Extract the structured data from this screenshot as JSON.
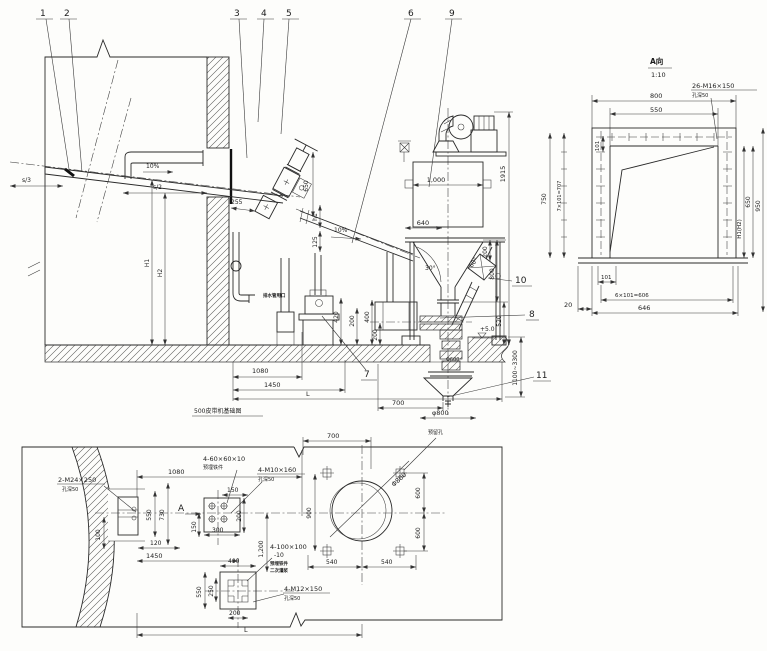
{
  "callouts": {
    "c1": "1",
    "c2": "2",
    "c3": "3",
    "c4": "4",
    "c5": "5",
    "c6": "6",
    "c7": "7",
    "c8": "8",
    "c9": "9",
    "c10": "10",
    "c11": "11"
  },
  "elev": {
    "s3": "s/3",
    "s2": "s/2",
    "slope_a": "10%",
    "slope_b": "10%",
    "d255": "255",
    "d650": "650",
    "h1": "h1",
    "d125": "125",
    "H1": "H1",
    "H2": "H2",
    "d1000": "1,000",
    "d640": "640",
    "d1915": "1915",
    "deg30": "30°",
    "deg60": "60°",
    "d200r": "200",
    "d800r": "800",
    "d520": "520",
    "level": "+5.0",
    "pit_depth": "1100~3300",
    "phi600": "Φ600",
    "d420": "420",
    "d200a": "200",
    "d400": "400",
    "d200b": "200",
    "d1080": "1080",
    "d1450": "1450",
    "L": "L",
    "d700": "700",
    "phi800": "φ800",
    "note500": "500皮带机基础图",
    "drain_note": "排水管甩口"
  },
  "detail": {
    "title": "A向",
    "scale": "1:10",
    "bolts": "26-M16×150",
    "bolts_note": "孔深50",
    "d800": "800",
    "d550": "550",
    "d101a": "101",
    "d7x101": "7×101=707",
    "d750": "750",
    "d650": "650",
    "d950": "950",
    "hh": "H1(H2)",
    "d101b": "101",
    "d6x101": "6×101=606",
    "d646": "646",
    "d20": "20"
  },
  "plan": {
    "m24": "2-M24×250",
    "m24_note": "孔深50",
    "p60": "4-60×60×10",
    "p60_note": "预埋铁件",
    "m10": "4-M10×160",
    "m10_note": "孔深50",
    "d150a": "150",
    "d200a": "200",
    "d300": "300",
    "d150b": "150",
    "d100": "100",
    "d550a": "550",
    "d730": "730",
    "d120": "120",
    "d1080": "1080",
    "A": "A",
    "d900": "900",
    "d700": "700",
    "phi800": "Φ800",
    "hole_note": "预留孔",
    "d600a": "600",
    "d600b": "600",
    "d540a": "540",
    "d540b": "540",
    "d1450": "1450",
    "d400": "400",
    "d550b": "550",
    "d250": "250",
    "d1200": "1,200",
    "d200b": "200",
    "p100": "4-100×100",
    "p100_t": "-10",
    "p100_n1": "预埋铁件",
    "p100_n2": "二次灌浆",
    "m12": "4-M12×150",
    "m12_note": "孔深50",
    "L": "L"
  }
}
